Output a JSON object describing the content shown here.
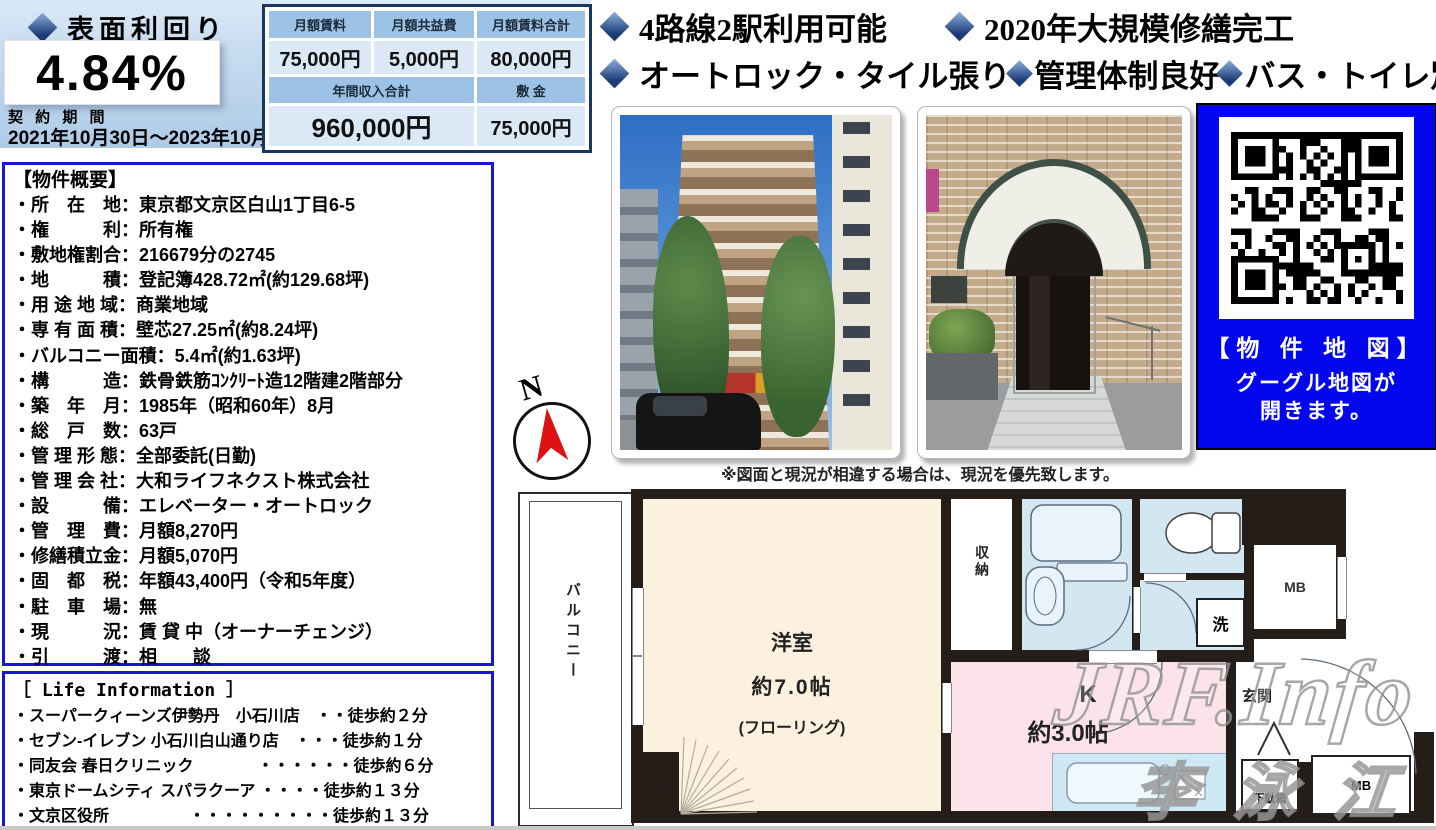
{
  "yield_panel": {
    "title": "表面利回り",
    "value": "4.84%",
    "contract_label": "契 約 期 間",
    "contract_period": "2021年10月30日～2023年10月29日"
  },
  "rent_table": {
    "col_headers": [
      "月額賃料",
      "月額共益費",
      "月額賃料合計"
    ],
    "col_values": [
      "75,000円",
      "5,000円",
      "80,000円"
    ],
    "annual_label": "年間収入合計",
    "annual_value": "960,000円",
    "deposit_label": "敷 金",
    "deposit_value": "75,000円"
  },
  "highlights": {
    "row1": [
      "4路線2駅利用可能",
      "2020年大規模修繕完工"
    ],
    "row2": [
      "オートロック・タイル張り",
      "管理体制良好",
      "バス・トイレ別"
    ]
  },
  "overview": {
    "title": "【物件概要】",
    "items": [
      "・所　在　地：東京都文京区白山1丁目6-5",
      "・権　　　利：所有権",
      "・敷地権割合：216679分の2745",
      "・地　　　積：登記簿428.72㎡(約129.68坪)",
      "・用 途 地 域：商業地域",
      "・専 有 面 積：壁芯27.25㎡(約8.24坪)",
      "・バルコニー面積：5.4㎡(約1.63坪)",
      "・構　　　造：鉄骨鉄筋ｺﾝｸﾘｰﾄ造12階建2階部分",
      "・築　年　月：1985年（昭和60年）8月",
      "・総　戸　数：63戸",
      "・管 理 形 態：全部委託(日勤)",
      "・管 理 会 社：大和ライフネクスト株式会社",
      "・設　　　備：エレベーター・オートロック",
      "・管　理　費：月額8,270円",
      "・修繕積立金：月額5,070円",
      "・固　都　税：年額43,400円（令和5年度）",
      "・駐　車　場：無",
      "・現　　　況：賃 貸 中（オーナーチェンジ）",
      "・引　　　渡：相　　談"
    ]
  },
  "life_info": {
    "title": "［ Life Information ］",
    "items": [
      "・スーパークィーンズ伊勢丹　小石川店　・・徒歩約２分",
      "・セブン-イレブン 小石川白山通り店　・・・徒歩約１分",
      "・同友会 春日クリニック　　　　・・・・・・徒歩約６分",
      "・東京ドームシティ スパラクーア ・・・・徒歩約１３分",
      "・文京区役所　　　　　・・・・・・・・・徒歩約１３分"
    ]
  },
  "plan_note": "※図面と現況が相違する場合は、現況を優先致します。",
  "map_panel": {
    "title": "【物 件 地 図】",
    "line1": "グーグル地図が",
    "line2": "開きます。"
  },
  "compass": {
    "label": "N"
  },
  "floorplan": {
    "balcony": "バルコニー",
    "room": "洋室",
    "room_size": "約7.0帖",
    "room_floor": "(フローリング)",
    "closet": "収納",
    "washer": "洗",
    "mb_top": "MB",
    "kitchen": "K",
    "kitchen_size": "約3.0帖",
    "entrance": "玄関",
    "shoe_box": "下駄箱",
    "mb_bottom": "MB"
  },
  "watermark": {
    "line1": "JRF.Info",
    "line2": "李泳江"
  },
  "colors": {
    "panel_blue": "#c3d9ee",
    "table_header": "#9cc2e5",
    "table_cell": "#dbe8f6",
    "table_border": "#17375e",
    "box_border": "#1717cf",
    "map_bg": "#0407ee",
    "room_cream": "#fbf1de",
    "room_pink": "#fce3ea",
    "room_blue": "#d3e7f3",
    "wall": "#241d18",
    "compass_arrow": "#dd1111"
  }
}
